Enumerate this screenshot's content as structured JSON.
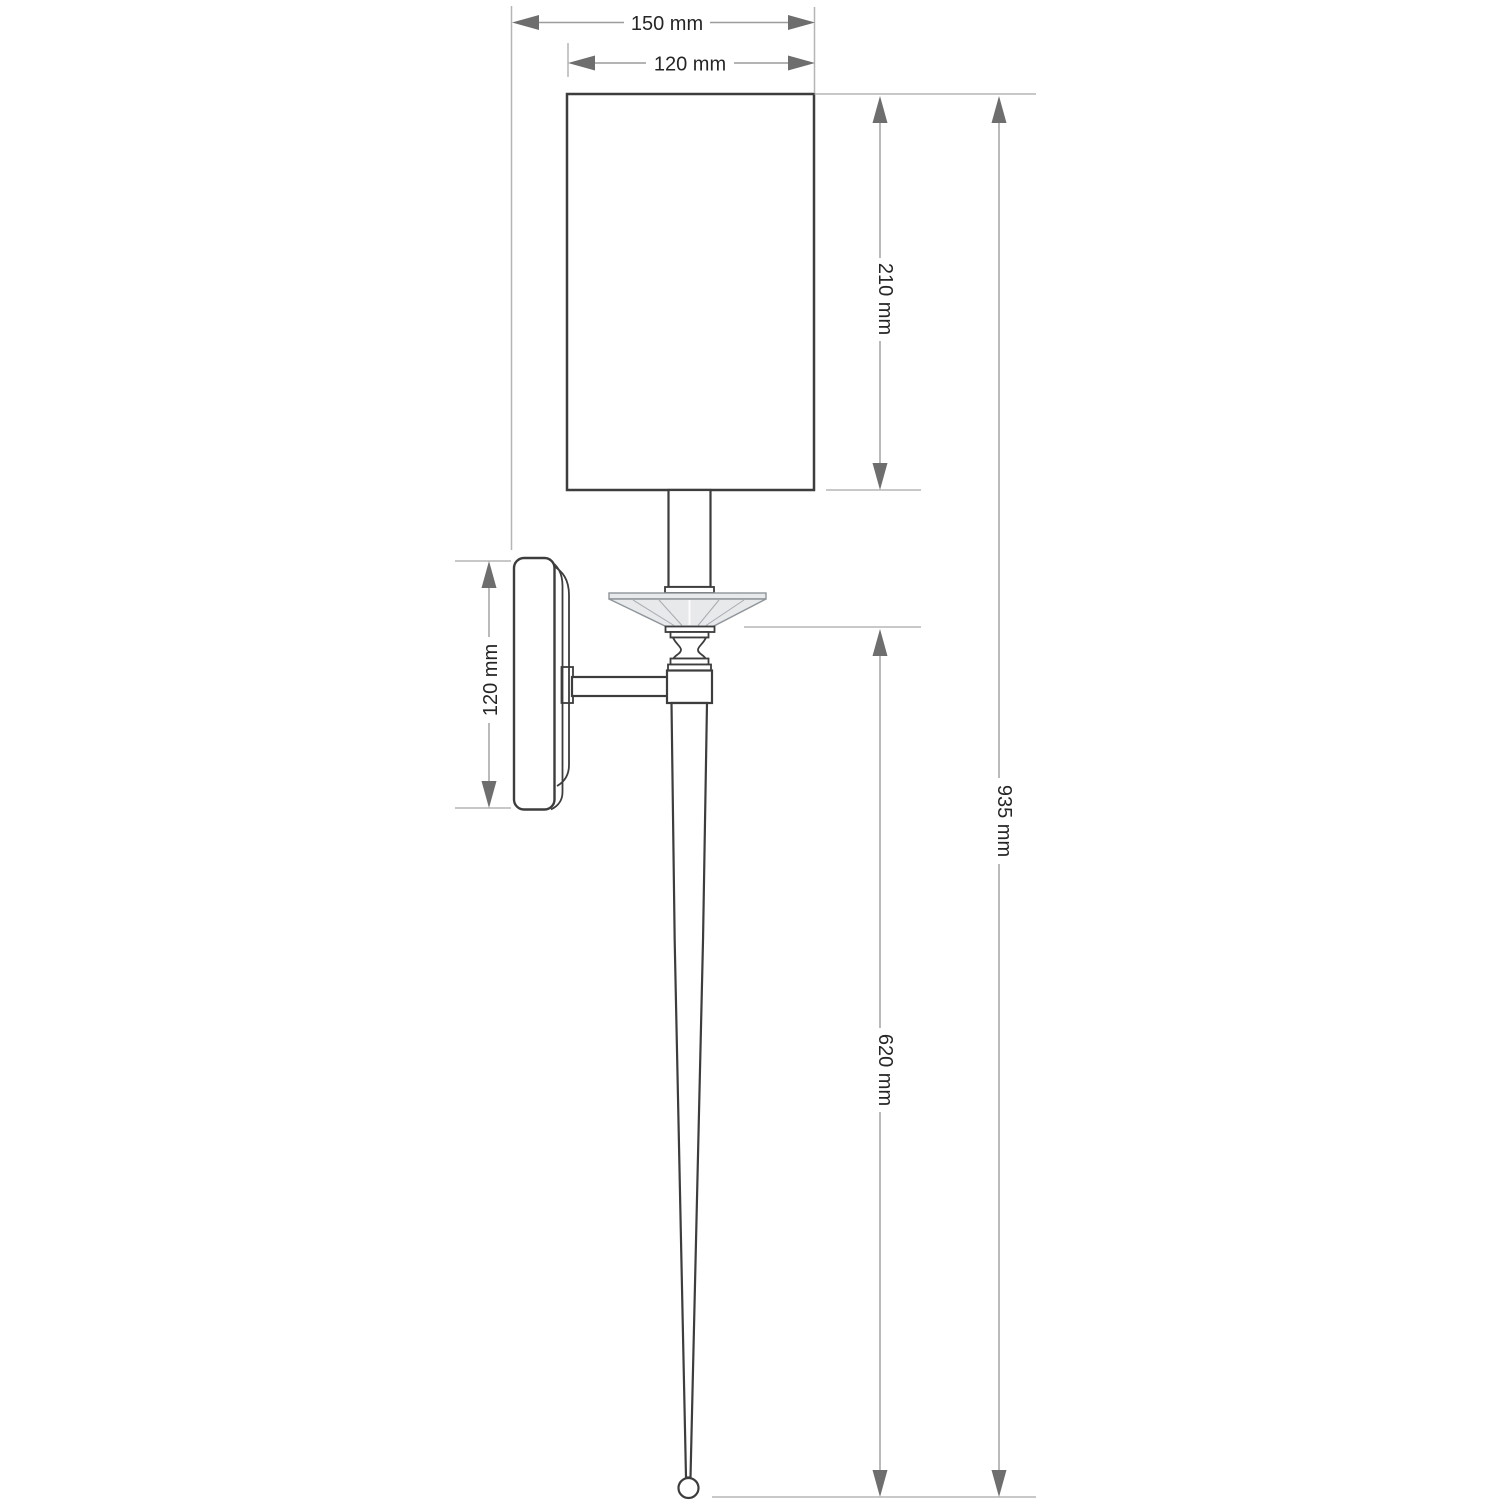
{
  "drawing": {
    "type": "technical-dimension-diagram",
    "subject": "wall sconce side elevation",
    "unit": "mm",
    "labels": {
      "overall_depth": "150 mm",
      "shade_width": "120 mm",
      "shade_height": "210 mm",
      "backplate_height": "120 mm",
      "overall_height": "935 mm",
      "stem_height": "620 mm"
    },
    "values": {
      "overall_depth_mm": 150,
      "shade_width_mm": 120,
      "shade_height_mm": 210,
      "backplate_height_mm": 120,
      "overall_height_mm": 935,
      "stem_height_mm": 620
    },
    "colors": {
      "background": "#ffffff",
      "fixture_outline": "#3d3d3d",
      "glass_fill": "#e7e9eb",
      "glass_outline": "#8f959a",
      "dimension_line": "#9c9c9c",
      "extension_line": "#b5b5b5",
      "arrowhead": "#6e6e6e",
      "text": "#262626"
    }
  }
}
